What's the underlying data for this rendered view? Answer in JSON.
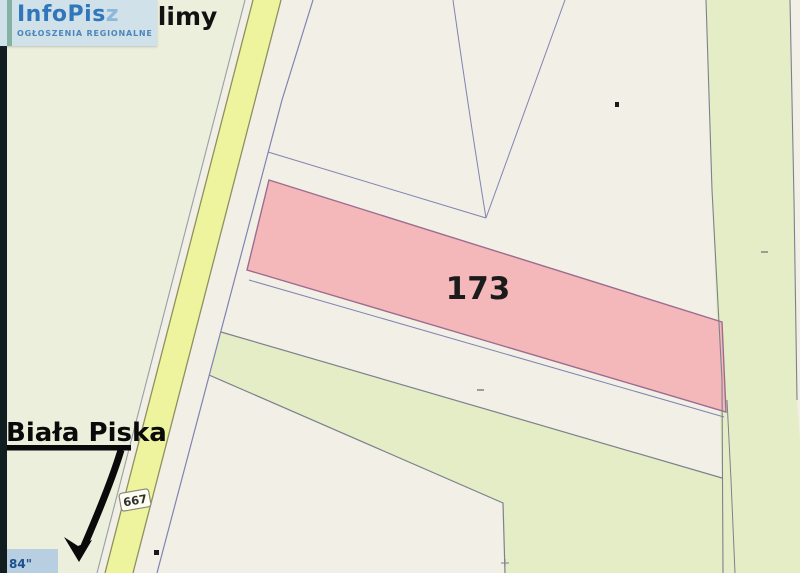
{
  "logo": {
    "brand": "InfoPis",
    "brand_suffix": "z",
    "tagline": "OGŁOSZENIA REGIONALNE"
  },
  "map": {
    "labels": {
      "village": "Sulimy",
      "town": "Biała Piska",
      "parcel_number": "173",
      "road_number": "667",
      "corner_coordinate": "84\""
    },
    "colors": {
      "parcel_highlight_fill": "#f4b7ba",
      "parcel_highlight_border": "#9c6d90",
      "road_fill": "#eef49e",
      "road_border": "#8e9060",
      "greenery_fill": "#e5edc6",
      "left_area_fill": "#ecefdc",
      "base_parcel_fill": "#f2efe6",
      "boundary_line": "#8083b2",
      "green_boundary_line": "#7c828c",
      "logo_blue": "#2f76ba",
      "logo_background": "#d0e1ea",
      "coordinate_patch": "#b7cfe0",
      "coordinate_text": "#1d4e8f"
    }
  }
}
